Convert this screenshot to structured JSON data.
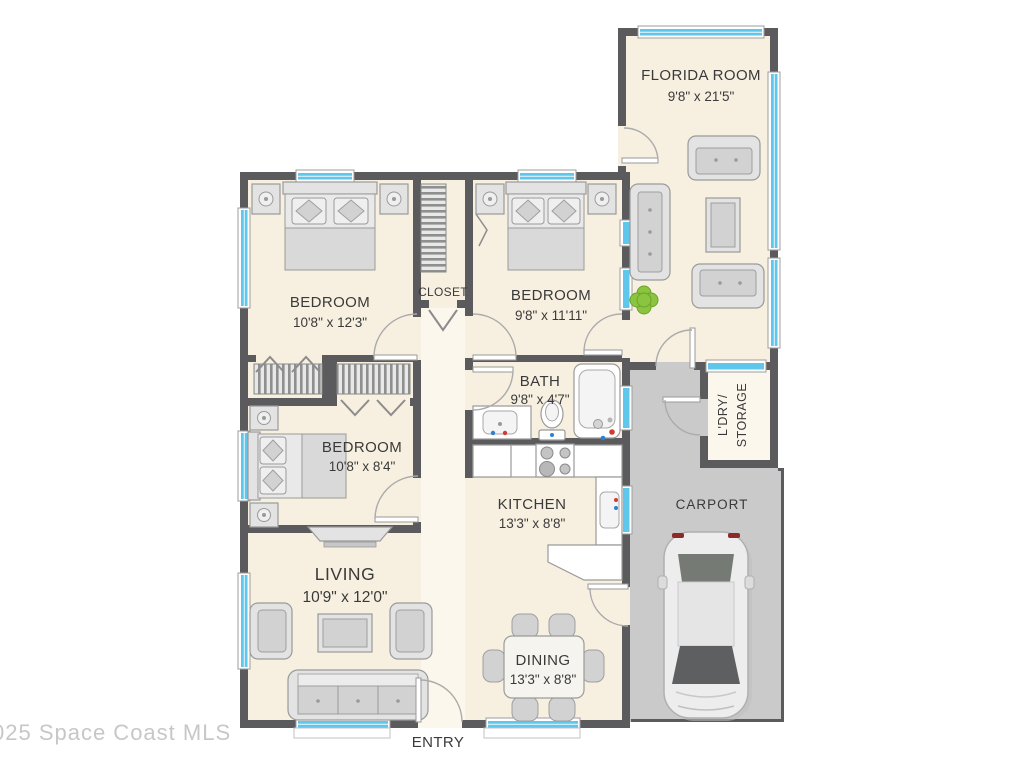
{
  "colors": {
    "wall": "#5b5a5c",
    "floor": "#f7f0e0",
    "hall": "#fbf7ec",
    "carport": "#cacaca",
    "glass": "#5fc6ec",
    "accent_red": "#d23b2f",
    "accent_blue": "#2f7fd2",
    "plant": "#8bc43f"
  },
  "watermark": "025 Space Coast MLS",
  "rooms": {
    "florida": {
      "name": "FLORIDA ROOM",
      "dims": "9'8\" x 21'5\""
    },
    "bedroom1": {
      "name": "BEDROOM",
      "dims": "10'8\" x 12'3\""
    },
    "bedroom2": {
      "name": "BEDROOM",
      "dims": "9'8\" x 11'11\""
    },
    "bedroom3": {
      "name": "BEDROOM",
      "dims": "10'8\" x 8'4\""
    },
    "closet": {
      "name": "CLOSET"
    },
    "bath": {
      "name": "BATH",
      "dims": "9'8\" x 4'7\""
    },
    "kitchen": {
      "name": "KITCHEN",
      "dims": "13'3\" x 8'8\""
    },
    "living": {
      "name": "LIVING",
      "dims": "10'9\" x 12'0\""
    },
    "dining": {
      "name": "DINING",
      "dims": "13'3\" x 8'8\""
    },
    "laundry": {
      "line1": "L'DRY/",
      "line2": "STORAGE"
    },
    "carport": {
      "name": "CARPORT"
    },
    "entry": {
      "name": "ENTRY"
    }
  }
}
